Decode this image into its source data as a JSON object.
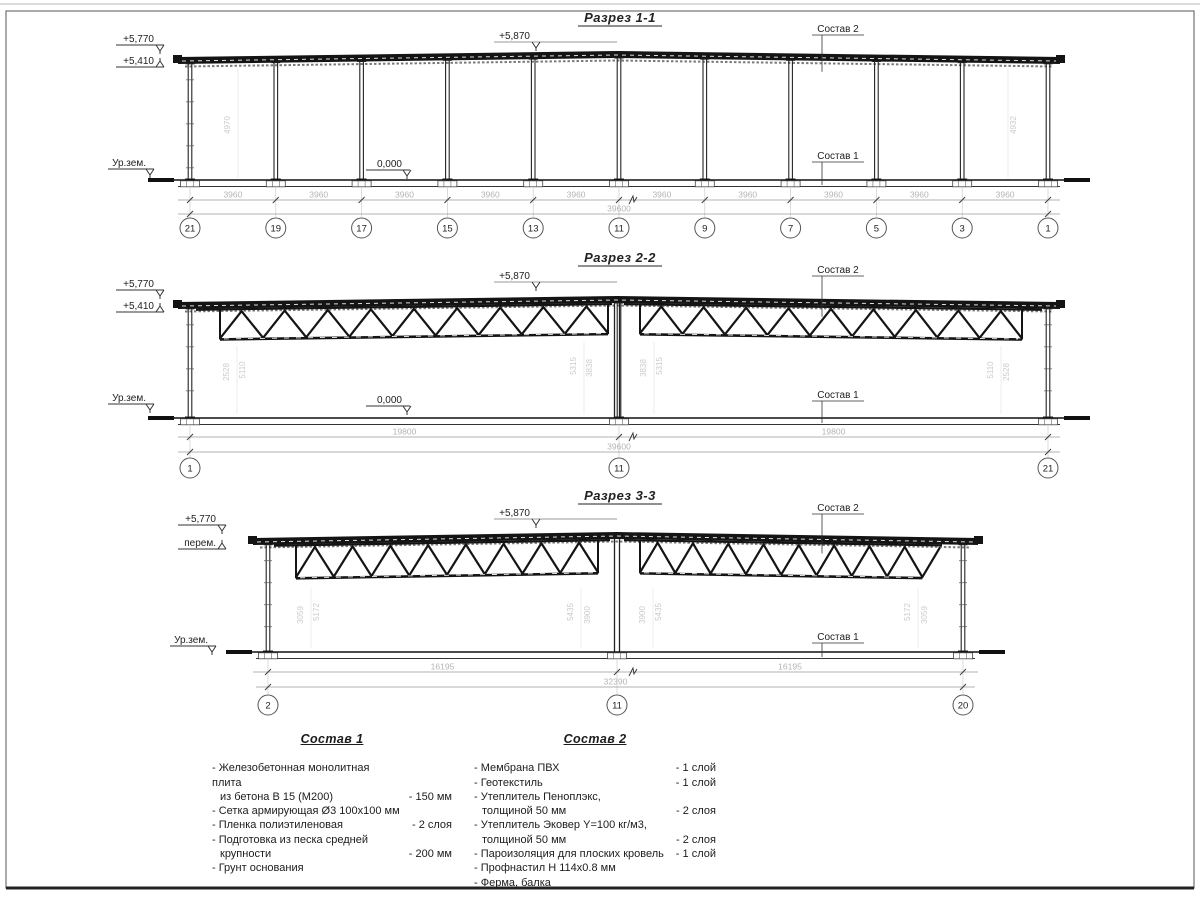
{
  "sheet": {
    "bg": "#ffffff",
    "line_color": "#1a1a1a",
    "dim_color": "#b4b4b4",
    "faint_color": "#cbcbcb",
    "frame_color": "#555555"
  },
  "sections": [
    {
      "title": "Разрез 1-1",
      "elev_top1": "+5,770",
      "elev_top2": "+5,410",
      "elev_ridge": "+5,870",
      "ground_label": "Ур.зем.",
      "zero_label": "0,000",
      "leader_top": "Состав 2",
      "leader_bottom": "Состав 1",
      "grid_labels": [
        "21",
        "19",
        "17",
        "15",
        "13",
        "11",
        "9",
        "7",
        "5",
        "3",
        "1"
      ],
      "bay_dims": [
        "3960",
        "3960",
        "3960",
        "3960",
        "3960",
        "3960",
        "3960",
        "3960",
        "3960",
        "3960"
      ],
      "overall_dim": "39600",
      "height_dims": [
        "4970",
        "4932"
      ]
    },
    {
      "title": "Разрез 2-2",
      "elev_top1": "+5,770",
      "elev_top2": "+5,410",
      "elev_ridge": "+5,870",
      "ground_label": "Ур.зем.",
      "zero_label": "0,000",
      "leader_top": "Состав 2",
      "leader_bottom": "Состав 1",
      "grid_labels": [
        "1",
        "11",
        "21"
      ],
      "span_dims": [
        "19800",
        "19800"
      ],
      "overall_dim": "39600",
      "height_dims": [
        "2528",
        "5110",
        "5315",
        "3838",
        "3838",
        "5315",
        "5110",
        "2528"
      ]
    },
    {
      "title": "Разрез 3-3",
      "elev_top1": "+5,770",
      "elev_top2": "перем.",
      "elev_ridge": "+5,870",
      "ground_label": "Ур.зем.",
      "leader_top": "Состав 2",
      "leader_bottom": "Состав 1",
      "grid_labels": [
        "2",
        "11",
        "20"
      ],
      "span_dims": [
        "16195",
        "16195"
      ],
      "overall_dim": "32390",
      "height_dims": [
        "3059",
        "5172",
        "5435",
        "3900",
        "3900",
        "5435",
        "5172",
        "3059"
      ]
    }
  ],
  "compositions": [
    {
      "title": "Состав 1",
      "items": [
        {
          "lines": [
            "- Железобетонная  монолитная плита",
            "из бетона В 15 (М200)"
          ],
          "value": "- 150 мм"
        },
        {
          "lines": [
            "- Сетка армирующая Ø3 100х100 мм"
          ],
          "value": ""
        },
        {
          "lines": [
            "- Пленка полиэтиленовая"
          ],
          "value": "- 2 слоя"
        },
        {
          "lines": [
            "- Подготовка из песка средней",
            "крупности"
          ],
          "value": "- 200 мм"
        },
        {
          "lines": [
            "- Грунт основания"
          ],
          "value": ""
        }
      ]
    },
    {
      "title": "Состав 2",
      "items": [
        {
          "lines": [
            "- Мембрана ПВХ"
          ],
          "value": "- 1 слой"
        },
        {
          "lines": [
            "- Геотекстиль"
          ],
          "value": "- 1 слой"
        },
        {
          "lines": [
            "- Утеплитель Пеноплэкс,",
            "толщиной 50 мм"
          ],
          "value": "- 2 слоя"
        },
        {
          "lines": [
            "- Утеплитель Эковер Y=100 кг/м3,",
            "толщиной 50 мм"
          ],
          "value": "- 2 слоя"
        },
        {
          "lines": [
            "- Пароизоляция для плоских кровель"
          ],
          "value": "- 1 слой"
        },
        {
          "lines": [
            "- Профнастил Н 114х0.8 мм"
          ],
          "value": ""
        },
        {
          "lines": [
            "- Ферма, балка"
          ],
          "value": ""
        }
      ]
    }
  ]
}
